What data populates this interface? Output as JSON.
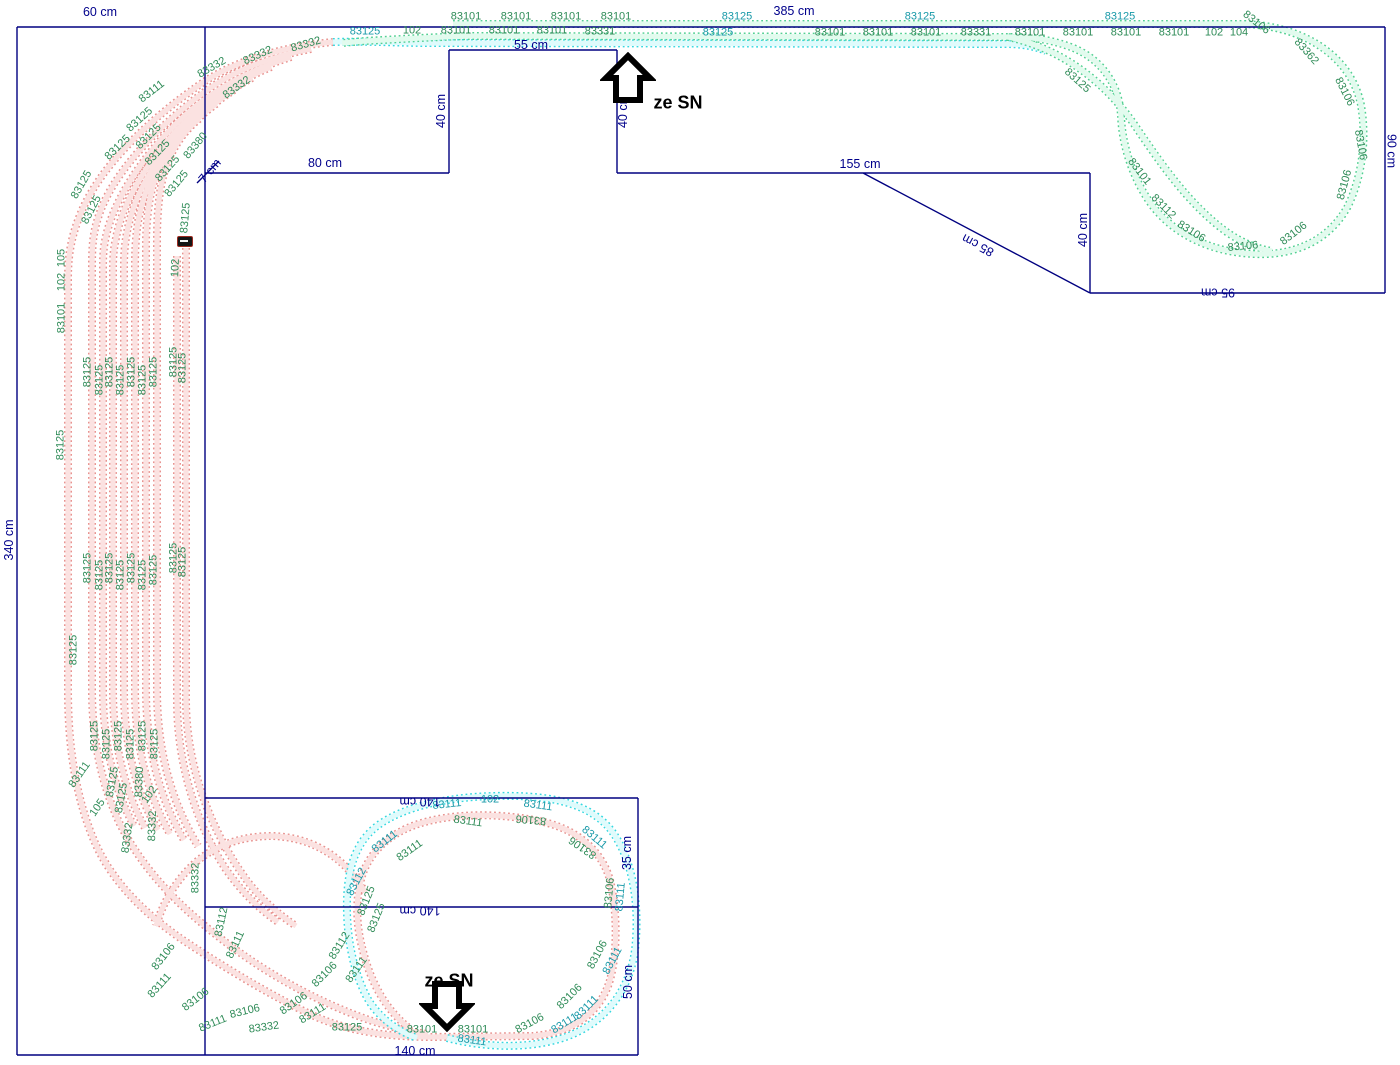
{
  "colors": {
    "board_outline": "#000080",
    "dimension_text": "#00008B",
    "label_green": "#2e8b57",
    "label_teal": "#1899a8",
    "pink_edge": "#e8928f",
    "pink_fill": "#fbe2e1",
    "cyan_edge": "#35d8e0",
    "cyan_fill": "#dffbfc",
    "green_edge": "#52d092",
    "green_fill": "#e2fbee"
  },
  "arrows": {
    "up": {
      "label": "ze SN"
    },
    "down": {
      "label": "ze SN"
    }
  },
  "dimension_labels": [
    {
      "t": "60 cm",
      "x": 100,
      "y": 12,
      "r": 0
    },
    {
      "t": "385 cm",
      "x": 794,
      "y": 11,
      "r": 0
    },
    {
      "t": "55 cm",
      "x": 531,
      "y": 45,
      "r": 0
    },
    {
      "t": "40 cm",
      "x": 441,
      "y": 111,
      "r": -90
    },
    {
      "t": "40 cm",
      "x": 623,
      "y": 111,
      "r": -90
    },
    {
      "t": "80 cm",
      "x": 325,
      "y": 163,
      "r": 0
    },
    {
      "t": "155 cm",
      "x": 860,
      "y": 164,
      "r": 0
    },
    {
      "t": "85 cm",
      "x": 978,
      "y": 245,
      "r": 208
    },
    {
      "t": "40 cm",
      "x": 1083,
      "y": 230,
      "r": -90
    },
    {
      "t": "90 cm",
      "x": 1391,
      "y": 151,
      "r": 90
    },
    {
      "t": "95 cm",
      "x": 1218,
      "y": 292,
      "r": 180
    },
    {
      "t": "340 cm",
      "x": 9,
      "y": 540,
      "r": -90
    },
    {
      "t": "7 cm",
      "x": 210,
      "y": 171,
      "r": -50
    },
    {
      "t": "140 cm",
      "x": 420,
      "y": 801,
      "r": 180
    },
    {
      "t": "140 cm",
      "x": 420,
      "y": 910,
      "r": 180
    },
    {
      "t": "140 cm",
      "x": 415,
      "y": 1051,
      "r": 0
    },
    {
      "t": "35 cm",
      "x": 627,
      "y": 853,
      "r": -90
    },
    {
      "t": "50 cm",
      "x": 628,
      "y": 982,
      "r": -90
    }
  ],
  "track_labels": [
    {
      "t": "83101",
      "x": 466,
      "y": 17,
      "r": 0
    },
    {
      "t": "83101",
      "x": 516,
      "y": 17,
      "r": 0
    },
    {
      "t": "83101",
      "x": 566,
      "y": 17,
      "r": 0
    },
    {
      "t": "83101",
      "x": 616,
      "y": 17,
      "r": 0
    },
    {
      "t": "83125",
      "x": 737,
      "y": 17,
      "r": 0,
      "c": "t"
    },
    {
      "t": "83125",
      "x": 920,
      "y": 17,
      "r": 0,
      "c": "t"
    },
    {
      "t": "83125",
      "x": 1120,
      "y": 17,
      "r": 0,
      "c": "t"
    },
    {
      "t": "83125",
      "x": 365,
      "y": 32,
      "r": 0,
      "c": "t"
    },
    {
      "t": "102",
      "x": 412,
      "y": 31,
      "r": 0
    },
    {
      "t": "83101",
      "x": 456,
      "y": 31,
      "r": 0
    },
    {
      "t": "83101",
      "x": 504,
      "y": 31,
      "r": 0
    },
    {
      "t": "83101",
      "x": 552,
      "y": 31,
      "r": 0
    },
    {
      "t": "83331",
      "x": 600,
      "y": 32,
      "r": 0
    },
    {
      "t": "83125",
      "x": 718,
      "y": 33,
      "r": 0,
      "c": "t"
    },
    {
      "t": "83101",
      "x": 830,
      "y": 33,
      "r": 0
    },
    {
      "t": "83101",
      "x": 878,
      "y": 33,
      "r": 0
    },
    {
      "t": "83101",
      "x": 926,
      "y": 33,
      "r": 0
    },
    {
      "t": "83331",
      "x": 976,
      "y": 33,
      "r": 0
    },
    {
      "t": "83101",
      "x": 1030,
      "y": 33,
      "r": 0
    },
    {
      "t": "83101",
      "x": 1078,
      "y": 33,
      "r": 0
    },
    {
      "t": "83101",
      "x": 1126,
      "y": 33,
      "r": 0
    },
    {
      "t": "83101",
      "x": 1174,
      "y": 33,
      "r": 0
    },
    {
      "t": "102",
      "x": 1214,
      "y": 33,
      "r": 0
    },
    {
      "t": "104",
      "x": 1239,
      "y": 33,
      "r": 0
    },
    {
      "t": "83106",
      "x": 1256,
      "y": 23,
      "r": 38
    },
    {
      "t": "83362",
      "x": 1306,
      "y": 52,
      "r": 48
    },
    {
      "t": "83106",
      "x": 1344,
      "y": 92,
      "r": 63
    },
    {
      "t": "83106",
      "x": 1360,
      "y": 145,
      "r": 80
    },
    {
      "t": "83106",
      "x": 1345,
      "y": 185,
      "r": -75
    },
    {
      "t": "83106",
      "x": 1294,
      "y": 234,
      "r": -38
    },
    {
      "t": "83106",
      "x": 1243,
      "y": 247,
      "r": -5
    },
    {
      "t": "83106",
      "x": 1191,
      "y": 232,
      "r": 32
    },
    {
      "t": "83112",
      "x": 1163,
      "y": 207,
      "r": 45
    },
    {
      "t": "83101",
      "x": 1139,
      "y": 172,
      "r": 52
    },
    {
      "t": "83125",
      "x": 1077,
      "y": 81,
      "r": 42
    },
    {
      "t": "83111",
      "x": 152,
      "y": 92,
      "r": -38
    },
    {
      "t": "83332",
      "x": 212,
      "y": 68,
      "r": -30
    },
    {
      "t": "83332",
      "x": 258,
      "y": 56,
      "r": -24
    },
    {
      "t": "83332",
      "x": 306,
      "y": 45,
      "r": -16
    },
    {
      "t": "83332",
      "x": 237,
      "y": 88,
      "r": -35
    },
    {
      "t": "83380",
      "x": 196,
      "y": 146,
      "r": -50
    },
    {
      "t": "83125",
      "x": 140,
      "y": 120,
      "r": -42
    },
    {
      "t": "83125",
      "x": 149,
      "y": 137,
      "r": -45
    },
    {
      "t": "83125",
      "x": 158,
      "y": 153,
      "r": -46
    },
    {
      "t": "83125",
      "x": 168,
      "y": 169,
      "r": -48
    },
    {
      "t": "83125",
      "x": 177,
      "y": 184,
      "r": -50
    },
    {
      "t": "83125",
      "x": 82,
      "y": 185,
      "r": -60
    },
    {
      "t": "83125",
      "x": 92,
      "y": 210,
      "r": -63
    },
    {
      "t": "83125",
      "x": 118,
      "y": 148,
      "r": -44
    },
    {
      "t": "83125",
      "x": 186,
      "y": 218,
      "r": -85
    },
    {
      "t": "102",
      "x": 176,
      "y": 268,
      "r": -88
    },
    {
      "t": "105",
      "x": 62,
      "y": 258,
      "r": -90
    },
    {
      "t": "102",
      "x": 62,
      "y": 282,
      "r": -90
    },
    {
      "t": "83101",
      "x": 62,
      "y": 318,
      "r": -90
    },
    {
      "t": "83125",
      "x": 61,
      "y": 445,
      "r": -90
    },
    {
      "t": "83125",
      "x": 74,
      "y": 650,
      "r": -90
    },
    {
      "t": "83125",
      "x": 88,
      "y": 372,
      "r": -90
    },
    {
      "t": "83125",
      "x": 100,
      "y": 380,
      "r": -90
    },
    {
      "t": "83125",
      "x": 110,
      "y": 372,
      "r": -90
    },
    {
      "t": "83125",
      "x": 121,
      "y": 380,
      "r": -90
    },
    {
      "t": "83125",
      "x": 132,
      "y": 372,
      "r": -90
    },
    {
      "t": "83125",
      "x": 143,
      "y": 380,
      "r": -90
    },
    {
      "t": "83125",
      "x": 154,
      "y": 372,
      "r": -90
    },
    {
      "t": "83125",
      "x": 174,
      "y": 362,
      "r": -90
    },
    {
      "t": "83125",
      "x": 183,
      "y": 368,
      "r": -90
    },
    {
      "t": "83125",
      "x": 88,
      "y": 568,
      "r": -90
    },
    {
      "t": "83125",
      "x": 100,
      "y": 575,
      "r": -90
    },
    {
      "t": "83125",
      "x": 110,
      "y": 568,
      "r": -90
    },
    {
      "t": "83125",
      "x": 121,
      "y": 575,
      "r": -90
    },
    {
      "t": "83125",
      "x": 132,
      "y": 568,
      "r": -90
    },
    {
      "t": "83125",
      "x": 143,
      "y": 575,
      "r": -90
    },
    {
      "t": "83125",
      "x": 154,
      "y": 570,
      "r": -90
    },
    {
      "t": "83125",
      "x": 174,
      "y": 558,
      "r": -90
    },
    {
      "t": "83125",
      "x": 183,
      "y": 562,
      "r": -90
    },
    {
      "t": "83125",
      "x": 95,
      "y": 736,
      "r": -90
    },
    {
      "t": "83125",
      "x": 107,
      "y": 744,
      "r": -90
    },
    {
      "t": "83125",
      "x": 119,
      "y": 736,
      "r": -90
    },
    {
      "t": "83125",
      "x": 131,
      "y": 744,
      "r": -90
    },
    {
      "t": "83125",
      "x": 143,
      "y": 736,
      "r": -90
    },
    {
      "t": "83125",
      "x": 155,
      "y": 744,
      "r": -90
    },
    {
      "t": "83111",
      "x": 80,
      "y": 775,
      "r": -55
    },
    {
      "t": "105",
      "x": 98,
      "y": 808,
      "r": -55
    },
    {
      "t": "83125",
      "x": 113,
      "y": 782,
      "r": -80
    },
    {
      "t": "83125",
      "x": 122,
      "y": 798,
      "r": -80
    },
    {
      "t": "83380",
      "x": 140,
      "y": 782,
      "r": -88
    },
    {
      "t": "102",
      "x": 150,
      "y": 795,
      "r": -55
    },
    {
      "t": "83332",
      "x": 128,
      "y": 838,
      "r": -82
    },
    {
      "t": "83332",
      "x": 153,
      "y": 826,
      "r": -88
    },
    {
      "t": "83332",
      "x": 196,
      "y": 878,
      "r": -90
    },
    {
      "t": "83112",
      "x": 222,
      "y": 922,
      "r": -78
    },
    {
      "t": "83111",
      "x": 236,
      "y": 945,
      "r": -65
    },
    {
      "t": "83106",
      "x": 164,
      "y": 957,
      "r": -52
    },
    {
      "t": "83111",
      "x": 160,
      "y": 986,
      "r": -48
    },
    {
      "t": "83106",
      "x": 196,
      "y": 1000,
      "r": -38
    },
    {
      "t": "83111",
      "x": 213,
      "y": 1024,
      "r": -22
    },
    {
      "t": "83106",
      "x": 245,
      "y": 1012,
      "r": -14
    },
    {
      "t": "83332",
      "x": 264,
      "y": 1028,
      "r": -8
    },
    {
      "t": "83106",
      "x": 294,
      "y": 1004,
      "r": -35
    },
    {
      "t": "83111",
      "x": 313,
      "y": 1014,
      "r": -32
    },
    {
      "t": "83112",
      "x": 340,
      "y": 946,
      "r": -58
    },
    {
      "t": "83111",
      "x": 357,
      "y": 970,
      "r": -55
    },
    {
      "t": "83106",
      "x": 325,
      "y": 975,
      "r": -45
    },
    {
      "t": "83125",
      "x": 347,
      "y": 1028,
      "r": 0
    },
    {
      "t": "83101",
      "x": 422,
      "y": 1030,
      "r": 0
    },
    {
      "t": "83101",
      "x": 473,
      "y": 1030,
      "r": 0
    },
    {
      "t": "83111",
      "x": 447,
      "y": 805,
      "r": -6,
      "c": "t"
    },
    {
      "t": "102",
      "x": 490,
      "y": 800,
      "r": 0,
      "c": "t"
    },
    {
      "t": "83111",
      "x": 538,
      "y": 806,
      "r": 8,
      "c": "t"
    },
    {
      "t": "83111",
      "x": 468,
      "y": 822,
      "r": 8
    },
    {
      "t": "83111",
      "x": 410,
      "y": 851,
      "r": -35
    },
    {
      "t": "83111",
      "x": 385,
      "y": 842,
      "r": -38,
      "c": "t"
    },
    {
      "t": "83112",
      "x": 357,
      "y": 882,
      "r": -62,
      "c": "t"
    },
    {
      "t": "83125",
      "x": 367,
      "y": 901,
      "r": -68
    },
    {
      "t": "83125",
      "x": 377,
      "y": 918,
      "r": -68
    },
    {
      "t": "83106",
      "x": 531,
      "y": 819,
      "r": 185
    },
    {
      "t": "83106",
      "x": 583,
      "y": 847,
      "r": 215
    },
    {
      "t": "83111",
      "x": 594,
      "y": 838,
      "r": 40,
      "c": "t"
    },
    {
      "t": "83106",
      "x": 610,
      "y": 893,
      "r": -85
    },
    {
      "t": "83111",
      "x": 621,
      "y": 897,
      "r": -85,
      "c": "t"
    },
    {
      "t": "83106",
      "x": 598,
      "y": 955,
      "r": -62
    },
    {
      "t": "83111",
      "x": 613,
      "y": 961,
      "r": -62,
      "c": "t"
    },
    {
      "t": "83106",
      "x": 570,
      "y": 997,
      "r": -45
    },
    {
      "t": "83111",
      "x": 587,
      "y": 1008,
      "r": -45,
      "c": "t"
    },
    {
      "t": "83106",
      "x": 530,
      "y": 1024,
      "r": -28
    },
    {
      "t": "83111",
      "x": 565,
      "y": 1024,
      "r": -32,
      "c": "t"
    },
    {
      "t": "83111",
      "x": 472,
      "y": 1041,
      "r": 8,
      "c": "t"
    }
  ]
}
